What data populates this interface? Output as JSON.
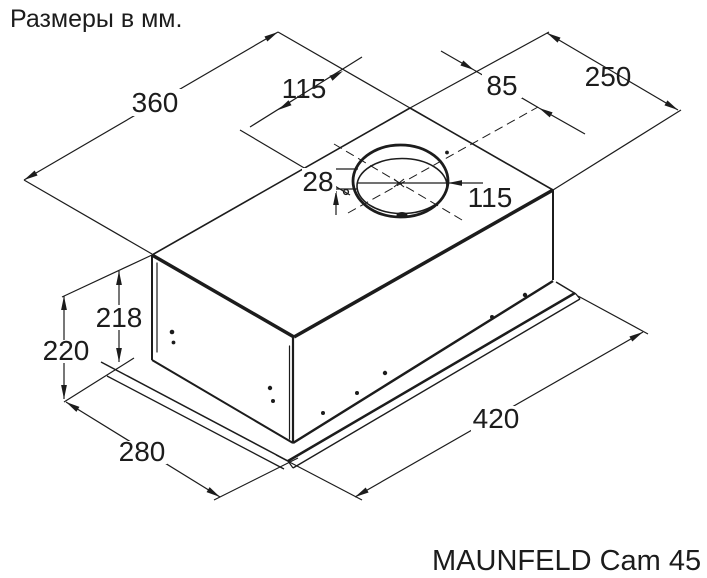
{
  "title": "Размеры в мм.",
  "model": "MAUNFELD Cam 45",
  "units": "мм",
  "drawing": "isometric technical drawing of built-in kitchen hood with mounting flange and round duct outlet",
  "dimensions": {
    "top_width": "360",
    "duct_offset_left": "115",
    "duct_offset_right": "85",
    "top_depth": "250",
    "collar_height": "28",
    "duct_diameter": "115",
    "body_height": "218",
    "total_height": "220",
    "flange_depth": "280",
    "flange_width": "420"
  },
  "colors": {
    "line": "#1c1c1c",
    "background": "#ffffff"
  }
}
